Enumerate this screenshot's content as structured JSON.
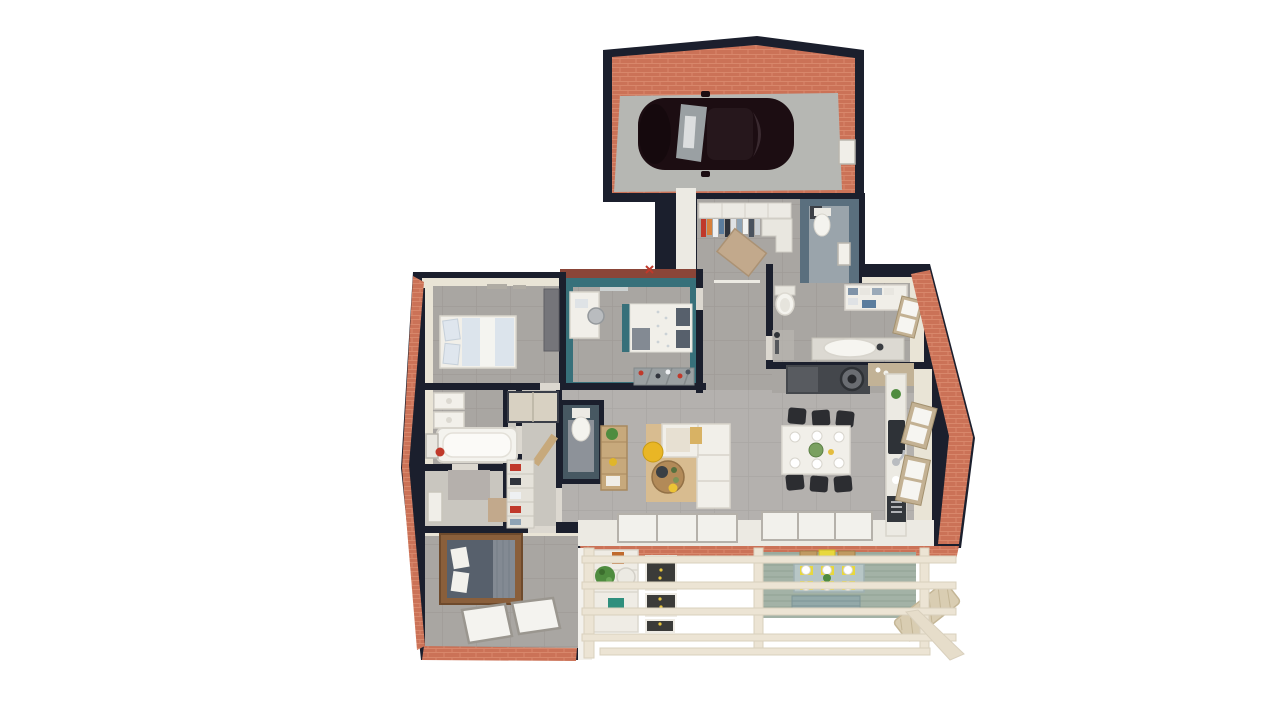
{
  "scene": {
    "kind": "3d-floorplan-top-down-render",
    "rooms": [
      {
        "name": "garage",
        "contents": [
          "dark-car",
          "brick-walls",
          "concrete-floor",
          "wall-niche"
        ]
      },
      {
        "name": "entry-closet",
        "contents": [
          "wardrobe-with-hanging-clothes",
          "corner-cabinet",
          "doormat"
        ]
      },
      {
        "name": "utility-room",
        "contents": [
          "toilet",
          "wall-frame",
          "slate-blue-walls"
        ]
      },
      {
        "name": "bedroom-1",
        "contents": [
          "double-bed-light-blue",
          "dresser",
          "ceiling-vents"
        ]
      },
      {
        "name": "bedroom-2",
        "contents": [
          "teal-walls",
          "double-bed-white",
          "desk",
          "chair",
          "shoe-shelf",
          "bench"
        ]
      },
      {
        "name": "bathroom-1",
        "contents": [
          "toilet",
          "towel-cabinet",
          "window",
          "vanity-oval-sink",
          "shower-corner"
        ]
      },
      {
        "name": "kitchen",
        "contents": [
          "dark-counter",
          "washer",
          "wood-counter",
          "island-counter-sink",
          "two-windows",
          "appliance"
        ]
      },
      {
        "name": "dining-area",
        "contents": [
          "white-table",
          "six-dark-chairs",
          "plates"
        ]
      },
      {
        "name": "living-room",
        "contents": [
          "l-shaped-white-sofa",
          "tan-rug",
          "round-coffee-table",
          "yellow-pouf",
          "yellow-bowl",
          "sliding-glass-doors"
        ]
      },
      {
        "name": "wc",
        "contents": [
          "toilet",
          "slate-walls",
          "wood-door-ajar"
        ]
      },
      {
        "name": "hall-console",
        "contents": [
          "wood-ladder-shelf",
          "plant"
        ]
      },
      {
        "name": "bathroom-2",
        "contents": [
          "bathtub",
          "two-wall-sinks",
          "mirror",
          "red-towel"
        ]
      },
      {
        "name": "hallway-left",
        "contents": [
          "door",
          "wood-threshold"
        ]
      },
      {
        "name": "closet",
        "contents": [
          "wardrobe",
          "shelves-with-clothes"
        ]
      },
      {
        "name": "bedroom-3",
        "contents": [
          "wood-frame-bed-dark-duvet",
          "two-floor-light-windows",
          "brick-walls"
        ]
      },
      {
        "name": "terrace",
        "contents": [
          "pergola-beams",
          "wood-deck",
          "plant-shelf",
          "dark-screens",
          "outdoor-dining-set",
          "slatted-bench",
          "rattan-rug"
        ]
      }
    ]
  },
  "colors": {
    "bg": "#ffffff",
    "wall": "#1b1f2d",
    "brick": "#cb7257",
    "brick_light": "#e2997b",
    "brick_dark": "#8a4538",
    "cream": "#e9e4d6",
    "white_floor": "#eceae3",
    "tile": "#a9a6a2",
    "tile_light": "#b4b1ae",
    "tile_lighter": "#c9c6bf",
    "garage_floor": "#b6b7b3",
    "car": "#1c0d12",
    "car_roof": "#26171c",
    "glass": "#9aa0a3",
    "teal": "#37707a",
    "slate": "#5a6f7e",
    "slate_deep": "#475862",
    "utility_floor": "#9aa4ab",
    "furn_white": "#f1efe9",
    "furn_stroke": "#d9d5cc",
    "bed_blue": "#dce4ec",
    "pillow_blue": "#dfe6ee",
    "duvet_dark": "#57606c",
    "knit": "#838a93",
    "wood": "#b28a58",
    "wood_dark": "#8a5f3b",
    "wood_light": "#c7a97c",
    "rug": "#d8bc90",
    "pouf": "#e9b625",
    "mat": "#c2a98c",
    "counter_dark": "#44474c",
    "counter_mid": "#585b60",
    "counter_wood": "#c2b296",
    "appliance": "#33373c",
    "chair_dark": "#2c2d31",
    "gray_furn": "#75757a",
    "shelf_gray": "#9aa0a2",
    "deck": "#a3b2a6",
    "deck_dark": "#8fa093",
    "pergola": "#ece4d4",
    "pergola_stroke": "#d9d0bd",
    "outdoor_table": "#b7c6c6",
    "outdoor_bench": "#93a9a9",
    "sun_yellow": "#e8d83c",
    "crate": "#c09a62",
    "screen_dark": "#3b3b39",
    "plant": "#4f8c3f",
    "teal_pot": "#2f8f7d",
    "orange_pot": "#c06a2e",
    "rattan": "#d9cdb2",
    "red_accent": "#c0392b",
    "frame_tan": "#c3b193",
    "window_white": "#f6f5f1"
  }
}
